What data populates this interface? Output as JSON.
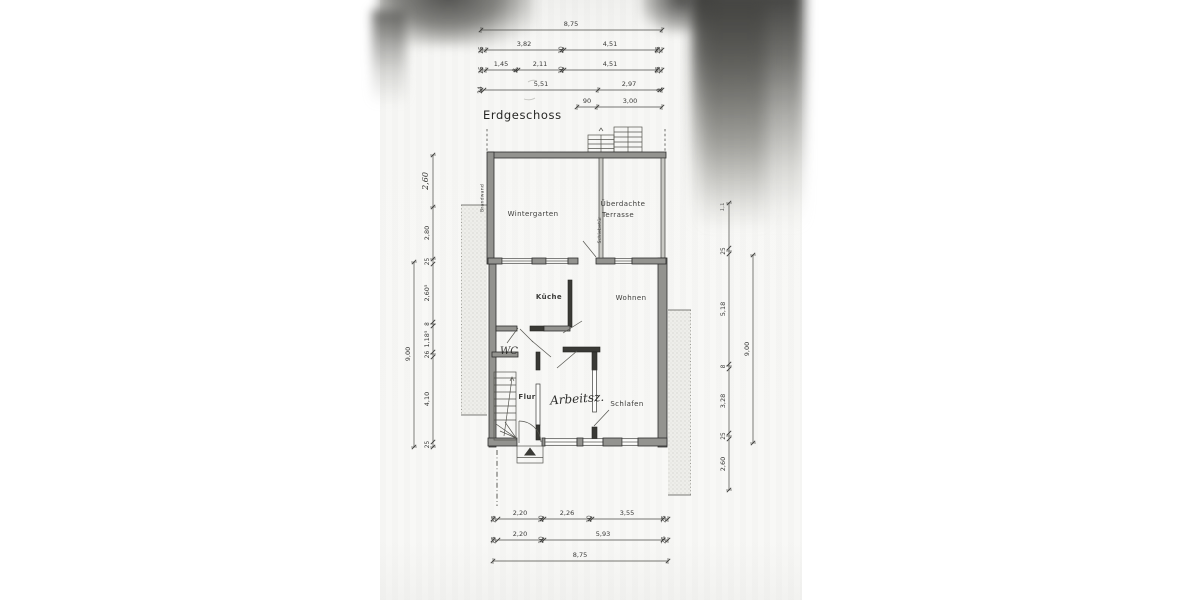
{
  "title": "Erdgeschoss",
  "rooms": {
    "wintergarten": "Wintergarten",
    "terrasse_line1": "Überdachte",
    "terrasse_line2": "Terrasse",
    "kueche": "Küche",
    "wohnen": "Wohnen",
    "wc": "WC",
    "flur": "Flur",
    "arbeitszimmer": "Arbeitsz.",
    "schlafen": "Schlafen"
  },
  "wall_labels": {
    "brandwand": "Brandwand",
    "schiebetuer": "Schiebetür"
  },
  "dimensions": {
    "top": {
      "total": "8,75",
      "row2": [
        "25",
        "3,82",
        "10",
        "4,51",
        "25"
      ],
      "row3": [
        "25",
        "1,45",
        "8",
        "2,11",
        "10",
        "4,51",
        "25"
      ],
      "row4": [
        "24",
        "5,51",
        "2,97",
        "9"
      ],
      "row5": [
        "90",
        "3,00"
      ]
    },
    "bottom": {
      "row1": [
        "25",
        "2,20",
        "10",
        "2,26",
        "10",
        "3,55",
        "25"
      ],
      "row2": [
        "25",
        "2,20",
        "10",
        "5,93",
        "26"
      ],
      "total": "8,75"
    },
    "left": {
      "total": "9,00",
      "chain": [
        "2,60",
        "2,80",
        "25",
        "2,60⁵",
        "8",
        "1,18⁵",
        "26",
        "4,10",
        "25"
      ]
    },
    "right": {
      "total": "9,00",
      "chain": [
        "1,1",
        "25",
        "5,18",
        "8",
        "3,28",
        "25",
        "2,60"
      ]
    }
  }
}
